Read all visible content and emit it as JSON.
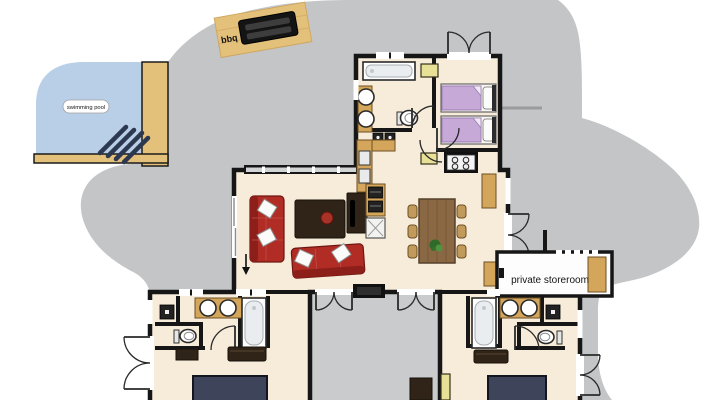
{
  "scene": {
    "kind": "house floor plan with garden, swimming pool and bbq deck",
    "labels": {
      "pool": "swimming pool",
      "bbq": "bbq",
      "storeroom": "private storeroom"
    },
    "palette": {
      "background": "#ffffff",
      "garden": "#c3c5c7",
      "courtyard": "#c9cbcd",
      "pool_water": "#b9cfe7",
      "deck_wood": "#e4c17b",
      "floor": "#f6ecd9",
      "wall": "#161616",
      "storeroom_floor": "#fdfdfd",
      "bed_lavender": "#c7a9d8",
      "bed_navy": "#3e4459",
      "sofa_red": "#b02c24",
      "dark_furniture": "#2f2417",
      "counter_wood": "#d3a65b",
      "mat_yellow": "#e9e098",
      "steps_navy": "#2b3850",
      "fence_gray": "#9b9b9b",
      "plant_green": "#3e7d32"
    },
    "rooms": [
      "swimming pool",
      "bbq deck",
      "bathroom north",
      "bedroom north",
      "living room",
      "kitchen and dining",
      "private storeroom",
      "courtyard",
      "bedroom south-west",
      "bathroom south-west",
      "bedroom south-east",
      "bathroom south-east"
    ],
    "furniture": [
      "bbq grill",
      "bathtub",
      "round sink",
      "toilet",
      "twin bed",
      "double bed",
      "sofa",
      "coffee table",
      "tv cabinet",
      "dining table",
      "chair",
      "stove",
      "kitchen sink",
      "dishwasher",
      "washer",
      "dresser",
      "bench",
      "wardrobe",
      "plant",
      "pool steps"
    ]
  }
}
